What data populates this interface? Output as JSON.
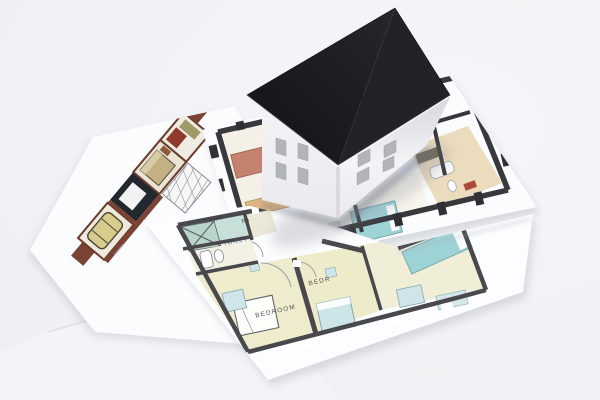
{
  "labels": {
    "shower": "SHWR",
    "bath": "BA",
    "toilet": "TOILET",
    "bedroom": "BEDROOM",
    "bedroom2": "BEDR"
  },
  "palette": {
    "background": "#edeff2",
    "background_bright": "#f5f6f9",
    "paper": "#fbfcfd",
    "paper_front": "#fcfdfe",
    "paper_blank": "#f3f4f7",
    "roof_dark": "#121216",
    "roof_light": "#26262c",
    "wall_bright": "#f4f4f7",
    "wall_mid": "#e9e9ee",
    "wall_shadow": "#d7d8dd",
    "window": "#b3b4ba",
    "plan_wall_mid": "#38383d",
    "plan_wall_front": "#48484d",
    "floor_cream": "#efecce",
    "floor_teal": "#c9dfd9",
    "furniture_teal": "#cfe5e9",
    "bed_teal": "#9ed3d6",
    "sofa_salmon": "#c5836f",
    "kitchen_tan": "#dbb583",
    "tile_tan": "#e5cfa2",
    "plant_green": "#7d9c5e",
    "mat_red": "#ae4a3a",
    "plan_brown": "#7a4334",
    "car_yellow": "#d6cc8c",
    "dark_room": "#23272e",
    "label_ink": "#3e3f44"
  },
  "house": {
    "left_window_count": 4,
    "right_window_count": 4
  }
}
